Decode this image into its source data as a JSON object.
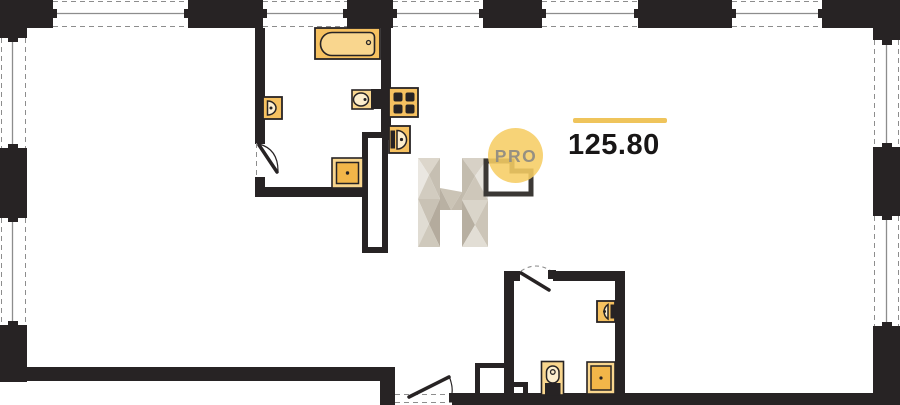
{
  "area": {
    "value": "125.80"
  },
  "logo": {
    "letter": "H",
    "badge": "PRO"
  },
  "colors": {
    "wall": "#272324",
    "glass": "#8d8d8d",
    "accent": "#efc45b",
    "fixture": "#f6c160",
    "fixture_light": "#f9d68e",
    "fixture_deep": "#f2b649",
    "fixture_pale": "#fdeecd",
    "logo_circle": "#f6cd64",
    "logo_gray": "#8e8b83"
  },
  "fixtures": [
    "bathtub",
    "toilet",
    "washbasin",
    "shower-tray",
    "gas-stove",
    "kitchen-washbasin",
    "washbasin-2",
    "toilet-2",
    "shower-tray-2"
  ]
}
